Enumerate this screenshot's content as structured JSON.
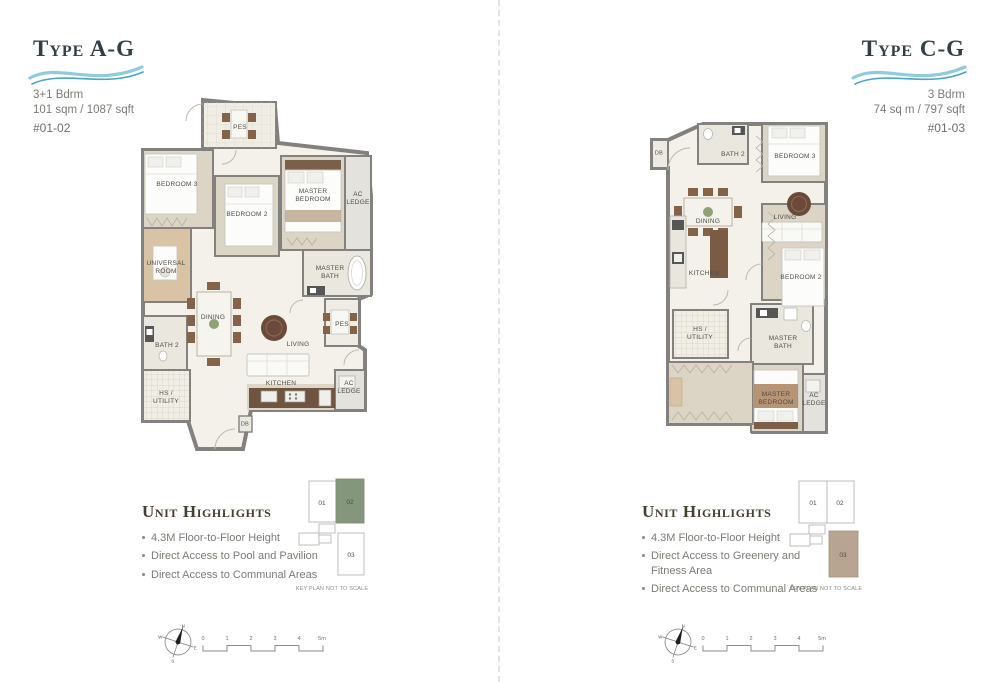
{
  "left": {
    "title": "Type A-G",
    "bedrooms": "3+1 Bdrm",
    "area": "101 sqm / 1087 sqft",
    "unit_no": "#01-02",
    "highlights_title": "Unit Highlights",
    "highlights": [
      "4.3M Floor-to-Floor Height",
      "Direct Access to Pool and Pavilion",
      "Direct Access to Communal Areas"
    ],
    "rooms": {
      "pes_top": "PES",
      "bedroom3": "BEDROOM 3",
      "bedroom2": "BEDROOM 2",
      "master_bedroom": "MASTER\nBEDROOM",
      "ac_ledge_1": "AC\nLEDGE",
      "universal_room": "UNIVERSAL\nROOM",
      "master_bath": "MASTER\nBATH",
      "dining": "DINING",
      "bath2": "BATH 2",
      "living": "LIVING",
      "pes_right": "PES",
      "hs_utility": "HS /\nUTILITY",
      "kitchen": "KITCHEN",
      "ac_ledge_2": "AC\nLEDGE",
      "db": "DB"
    },
    "key_plan": {
      "unit_01": "01",
      "unit_02": "02",
      "unit_03": "03",
      "caption": "KEY PLAN NOT TO SCALE"
    },
    "compass": {
      "n": "N",
      "e": "E",
      "s": "S",
      "w": "W"
    },
    "scale_bar": {
      "t0": "0",
      "t1": "1",
      "t2": "2",
      "t3": "3",
      "t4": "4",
      "t5": "5m"
    }
  },
  "right": {
    "title": "Type C-G",
    "bedrooms": "3 Bdrm",
    "area": "74 sq m / 797 sqft",
    "unit_no": "#01-03",
    "highlights_title": "Unit Highlights",
    "highlights": [
      "4.3M Floor-to-Floor Height",
      "Direct Access to Greenery and Fitness Area",
      "Direct Access to Communal Areas"
    ],
    "rooms": {
      "db": "DB",
      "bath2": "BATH 2",
      "bedroom3": "BEDROOM 3",
      "dining": "DINING",
      "living": "LIVING",
      "kitchen": "KITCHEN",
      "bedroom2": "BEDROOM 2",
      "hs_utility": "HS /\nUTILITY",
      "master_bath": "MASTER\nBATH",
      "master_bedroom": "MASTER\nBEDROOM",
      "ac_ledge": "AC\nLEDGE"
    },
    "key_plan": {
      "unit_01": "01",
      "unit_02": "02",
      "unit_03": "03",
      "caption": "KEY PLAN NOT TO SCALE"
    },
    "compass": {
      "n": "N",
      "e": "E",
      "s": "S",
      "w": "W"
    },
    "scale_bar": {
      "t0": "0",
      "t1": "1",
      "t2": "2",
      "t3": "3",
      "t4": "4",
      "t5": "5m"
    }
  },
  "colors": {
    "highlight_unit_left": "#84977c",
    "highlight_unit_right": "#b7a591",
    "wave_light": "#8fcbdd",
    "wave_dark": "#4aa5c4",
    "wall_gray": "#83817d",
    "floor_beige": "#dcd4c5"
  }
}
